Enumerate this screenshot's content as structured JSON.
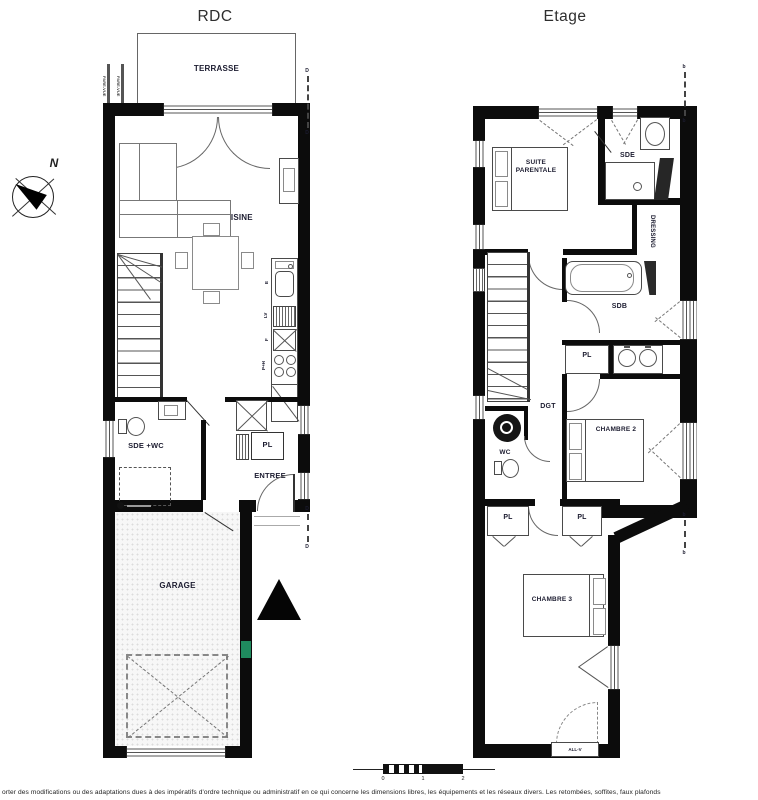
{
  "titles": {
    "rdc": "RDC",
    "etage": "Etage"
  },
  "compass": {
    "north": "N"
  },
  "rdc": {
    "terrasse": "TERRASSE",
    "sejour_cuisine": "SEJOUR + CUISINE",
    "sde_wc": "SDE +WC",
    "pl": "PL",
    "entree": "ENTREE",
    "garage": "GARAGE",
    "fence_label": "PARE-VUE",
    "kitchen": {
      "evier": "E",
      "lave_vaisselle": "LV",
      "four": "F",
      "plaques": "P+H"
    },
    "marker": "D"
  },
  "etage": {
    "suite_parentale": "SUITE PARENTALE",
    "sde": "SDE",
    "dressing": "DRESSING",
    "sdb": "SDB",
    "pl_sdb": "PL",
    "dgt": "DGT",
    "wc": "WC",
    "chambre2": "CHAMBRE 2",
    "pl_hall_left": "PL",
    "pl_hall_right": "PL",
    "chambre3": "CHAMBRE 3",
    "all_v": "ALL-V",
    "marker": "b"
  },
  "scale_bar": {
    "t0": "0",
    "t1": "1",
    "t2": "2"
  },
  "footer": "orter des modifications ou des adaptations dues à des impératifs d'ordre technique ou administratif en ce qui concerne les dimensions libres, les équipements et les réseaux divers. Les retombées, soffites, faux plafonds",
  "colors": {
    "wall": "#0c0c0c",
    "label": "#1c1c30",
    "green_marker": "#1f8a5e"
  }
}
